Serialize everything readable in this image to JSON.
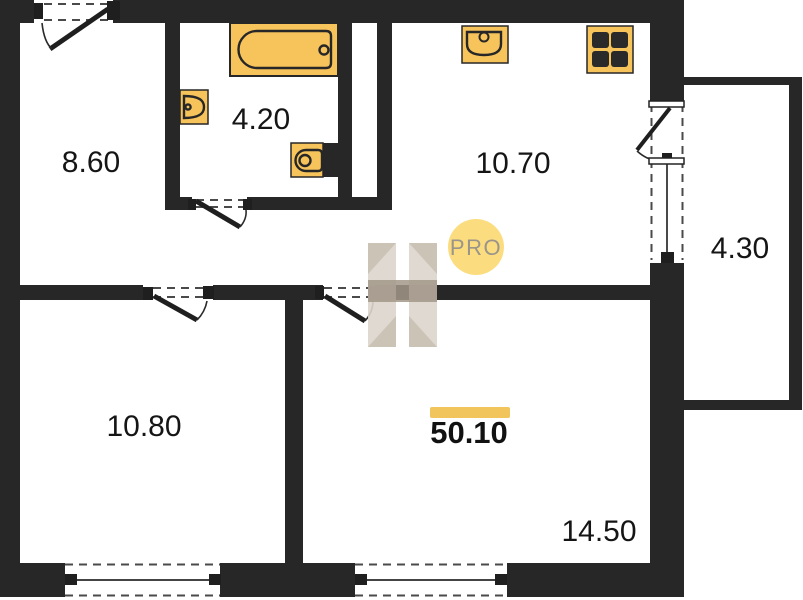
{
  "plan": {
    "watermark": {
      "logo_text": "PRO"
    },
    "total_area": "50.10",
    "rooms": {
      "hallway": "8.60",
      "bathroom": "4.20",
      "kitchen": "10.70",
      "balcony": "4.30",
      "bedroom": "10.80",
      "living_room": "14.50"
    },
    "fixtures": [
      "bathtub",
      "wash-basin",
      "toilet",
      "kitchen-sink",
      "stove"
    ],
    "colors": {
      "wall": "#272727",
      "fixture": "#f7c45c",
      "fixture_border": "#272727",
      "accent": "#f2c45c",
      "watermark_circle": "#fbdd80",
      "watermark_text": "#9a948a",
      "watermark_logo": "#dbd5cc"
    }
  }
}
